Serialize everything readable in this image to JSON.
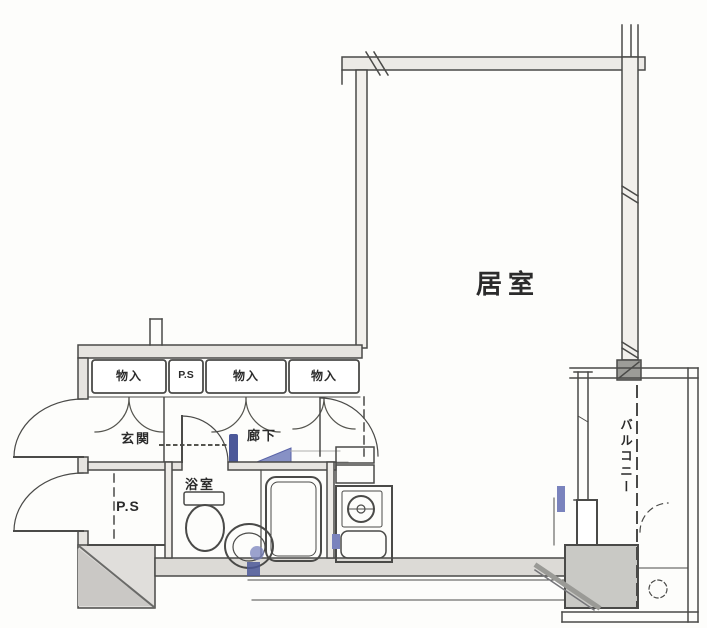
{
  "floorplan": {
    "rooms": {
      "living_room": "居室",
      "entrance": "玄関",
      "hallway": "廊下",
      "bathroom": "浴室",
      "balcony": "バルコニー",
      "storage_1": "物入",
      "storage_2": "物入",
      "storage_3": "物入",
      "pipe_space_upper": "P.S",
      "pipe_space_lower": "P.S"
    },
    "colors": {
      "line": "#4a4a48",
      "wall_fill": "#e6e4e0",
      "pillar_fill": "#c9c9c5",
      "accent_blue": "#7a83bd",
      "accent_blue_dark": "#4c5899",
      "background": "#fdfdfb"
    }
  }
}
